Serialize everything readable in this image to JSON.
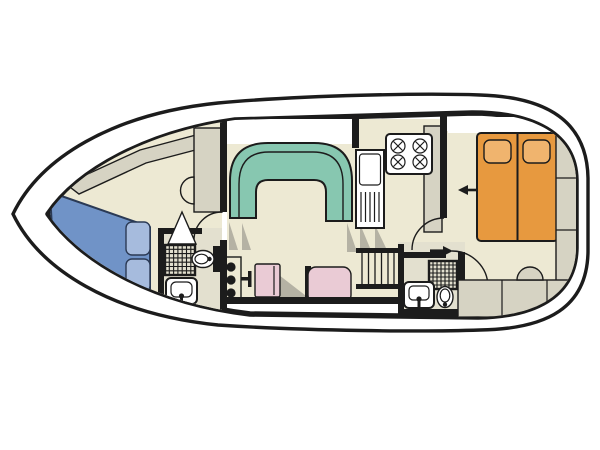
{
  "diagram": {
    "type": "boat-floor-plan",
    "title": "Motor cruiser interior layout plan (top view)",
    "orientation": "bow-left-stern-right",
    "rooms": [
      {
        "name": "bow-cabin",
        "features": [
          "v-berth-double-bed",
          "two-pillows",
          "corner-cabinet",
          "curved-counter",
          "vanity-half-round"
        ]
      },
      {
        "name": "forward-bathroom",
        "features": [
          "shower",
          "toilet",
          "washbasin",
          "door"
        ]
      },
      {
        "name": "saloon",
        "features": [
          "u-shaped-dinette-sofa",
          "helm-console",
          "helm-seat",
          "settee",
          "step-shading"
        ]
      },
      {
        "name": "galley",
        "features": [
          "four-burner-stove",
          "sink-with-drainer",
          "worktop",
          "companionway-stairs"
        ]
      },
      {
        "name": "aft-bathroom",
        "features": [
          "shower",
          "toilet",
          "washbasin"
        ]
      },
      {
        "name": "aft-cabin",
        "features": [
          "double-bed-two-mattresses",
          "two-pillows",
          "side-cabinets",
          "stern-cabinets",
          "stool",
          "entry-arrow"
        ]
      }
    ],
    "arrows": [
      {
        "name": "aft-cabin-entry-arrow",
        "direction": "left"
      },
      {
        "name": "aft-bathroom-door-arrow",
        "direction": "right"
      }
    ]
  },
  "colors": {
    "ink": "#1c1c1c",
    "white": "#ffffff",
    "floor": "#EDE9D3",
    "floor_bath": "#E3E0CF",
    "furniture_gray": "#D6D3C3",
    "shadow_gray": "#B5B2A4",
    "sofa_teal": "#87C7B0",
    "sofa_teal_line": "#1c1c1c",
    "bed_blue": "#7093C7",
    "pillow_blue": "#A6BBDD",
    "bed_blue_line": "#2b3a55",
    "bed_orange": "#E7993F",
    "pillow_orange": "#F0B46E",
    "seat_pink": "#EACBD5"
  }
}
